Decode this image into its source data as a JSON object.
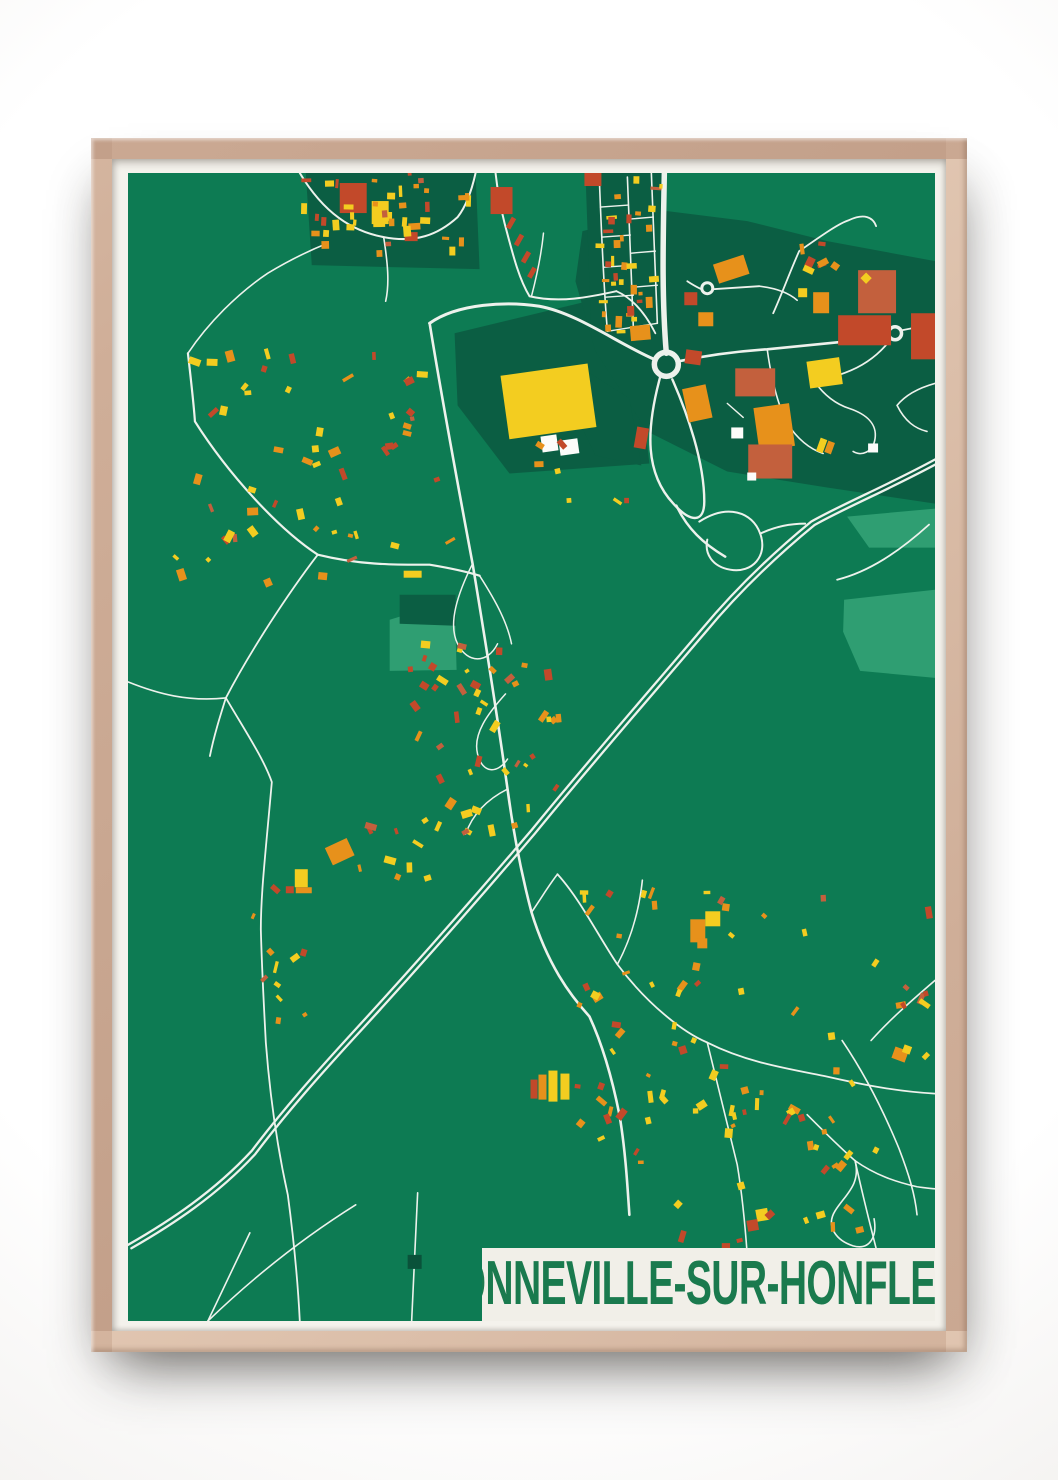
{
  "poster": {
    "title": "GONNEVILLE-SUR-HONFLEUR"
  },
  "band": {
    "x": 354,
    "y": 1073,
    "w": 454,
    "h": 73,
    "bg": "#f1efe8",
    "text_color": "#1a7a4e",
    "font_size": 62
  },
  "palette": {
    "base": "#0d7b53",
    "dark": "#0b5e43",
    "darker": "#0a523a",
    "light": "#2f9e72",
    "road": "#edf2ec",
    "y": "#f3cd20",
    "o": "#e7911b",
    "r": "#c2492a",
    "t": "#c3603d",
    "w": "#fcfcfa",
    "g": "#0a523a",
    "matte": "#f4f2ec",
    "frame_wood": "#cfae98",
    "wall": "#ffffff"
  },
  "map": {
    "width": 808,
    "height": 1146,
    "patches_dark": [
      "327,160 502,118 522,290 382,300 330,232",
      "455,58 540,38 620,48 700,68 808,88 808,330 700,314 600,298 520,258 468,178 448,108",
      "455,195 502,225 514,292 468,282 446,236",
      "458,0 535,0 541,165 464,163",
      "178,0 348,0 352,96 184,92",
      "272,421 328,421 328,452 272,450"
    ],
    "patches_light": [
      "262,446 327,426 329,496 262,497",
      "717,426 808,416 808,504 733,497 716,458",
      "720,343 808,335 808,374 742,374",
      "700,1120 790,1112 800,1146 706,1146"
    ],
    "roads": [
      {
        "d": "M537,0 C536,60 534,120 539,180",
        "w": 5.5
      },
      {
        "d": "M527,186 C490,170 450,140 412,133 C380,128 330,130 302,150",
        "w": 3
      },
      {
        "d": "M302,150 C315,230 330,310 345,390 C355,450 368,530 380,615 C386,660 394,700 404,738 C420,790 442,820 462,842 C475,870 485,905 492,940 C498,975 500,1010 502,1040",
        "w": 2.6
      },
      {
        "d": "M368,0 C370,18 373,34 377,50 C385,80 391,105 402,123 C432,130 462,124 489,118",
        "w": 2
      },
      {
        "d": "M489,118 C505,125 518,140 528,160",
        "w": 1.8
      },
      {
        "d": "M60,180 C64,215 66,232 67,248 C100,300 150,355 190,381 C235,392 270,391 302,391 C320,394 336,397 352,402",
        "w": 2.2
      },
      {
        "d": "M190,381 C160,420 122,478 98,524 C92,543 86,562 82,582",
        "w": 1.8
      },
      {
        "d": "M98,524 C118,558 136,585 144,608 C138,676 133,718 133,755 C134,795 136,830 138,868 C142,920 150,975 160,1020 C166,1065 170,1105 172,1146",
        "w": 1.8
      },
      {
        "d": "M0,508 C30,520 60,528 98,524",
        "w": 1.6
      },
      {
        "d": "M172,0 C196,40 224,58 256,64 C288,70 310,62 330,44 C338,34 344,18 348,0",
        "w": 2
      },
      {
        "d": "M256,64 C260,90 262,110 258,128",
        "w": 1.6
      },
      {
        "d": "M60,180 C80,150 110,120 140,100 C160,88 180,78 200,70",
        "w": 1.6
      },
      {
        "d": "M472,8 C474,60 476,110 480,158",
        "w": 1.6
      },
      {
        "d": "M500,4 C502,55 504,105 506,155",
        "w": 1.6
      },
      {
        "d": "M524,0 C526,50 528,100 530,150",
        "w": 1.6
      },
      {
        "d": "M473,34 L501,32",
        "w": 1.4
      },
      {
        "d": "M475,64 L503,62",
        "w": 1.4
      },
      {
        "d": "M477,94 L505,92",
        "w": 1.4
      },
      {
        "d": "M478,124 L506,122",
        "w": 1.4
      },
      {
        "d": "M502,46 L526,44",
        "w": 1.4
      },
      {
        "d": "M504,80 L528,78",
        "w": 1.4
      },
      {
        "d": "M506,114 L530,112",
        "w": 1.4
      },
      {
        "d": "M480,158 L530,150",
        "w": 1.4
      },
      {
        "d": "M560,108 C566,112 570,114 574,116",
        "w": 1.8
      },
      {
        "d": "M586,116 L632,113",
        "w": 1.8
      },
      {
        "d": "M632,113 C650,115 662,120 670,127",
        "w": 1.6
      },
      {
        "d": "M646,140 C655,120 663,98 672,78 C695,62 712,50 722,47 C737,40 746,44 749,53",
        "w": 1.8
      },
      {
        "d": "M551,188 C580,182 610,178 640,176 C680,172 720,168 761,164",
        "w": 2.6
      },
      {
        "d": "M775,157 C790,154 800,152 808,151",
        "w": 1.8
      },
      {
        "d": "M763,167 C752,181 738,191 724,197 C710,203 698,206 688,209",
        "w": 1.8
      },
      {
        "d": "M688,209 C698,223 710,231 722,235 C740,241 750,251 748,265 C746,279 734,283 726,278",
        "w": 1.6
      },
      {
        "d": "M640,176 C644,205 650,230 660,250 C672,268 684,276 696,280",
        "w": 1.6
      },
      {
        "d": "M600,230 L616,244",
        "w": 1.4
      },
      {
        "d": "M660,250 C655,270 650,285 648,300",
        "w": 1.4
      },
      {
        "d": "M808,210 C790,215 778,222 770,232 C778,248 788,255 800,258",
        "w": 1.6
      },
      {
        "d": "M533,203 C518,258 518,300 546,330 C564,350 577,349 577,328 C577,288 560,240 545,206",
        "w": 2.4
      },
      {
        "d": "M549,332 C560,355 576,370 598,383",
        "w": 2.4
      },
      {
        "d": "M572,348 C600,330 625,338 633,360 C641,382 625,400 603,396 C585,393 577,380 580,366",
        "w": 2
      },
      {
        "d": "M633,360 C650,352 665,350 678,350",
        "w": 2
      },
      {
        "d": "M808,286 C760,312 716,330 684,348 C640,384 604,420 574,456 C515,525 458,590 404,656 C345,725 283,795 224,859 C190,896 155,935 124,976 C86,1017 42,1046 0,1070",
        "w": 2.3,
        "dup": [
          3.4,
          3.4
        ]
      },
      {
        "d": "M802,351 C772,378 742,398 710,406",
        "w": 1.8
      },
      {
        "d": "M404,738 C415,722 422,710 430,700",
        "w": 1.6
      },
      {
        "d": "M430,700 C452,724 470,760 490,790 C520,830 556,858 580,868 C620,888 660,894 700,902 C740,911 772,917 808,919",
        "w": 1.8
      },
      {
        "d": "M515,706 C512,734 505,762 490,790",
        "w": 1.6
      },
      {
        "d": "M580,868 C590,910 600,950 610,990 C615,1020 618,1052 620,1080",
        "w": 1.6
      },
      {
        "d": "M715,866 C738,900 758,940 772,974 C782,1000 788,1020 790,1040",
        "w": 1.6
      },
      {
        "d": "M680,940 C700,960 714,974 728,986 C748,1000 768,1007 790,1012 C798,1013 804,1014 808,1014",
        "w": 1.6
      },
      {
        "d": "M728,986 C734,1010 718,1020 708,1036 C698,1052 710,1066 726,1071 C744,1076 750,1060 747,1044",
        "w": 1.6
      },
      {
        "d": "M728,986 C738,1032 752,1086 768,1146",
        "w": 1.6
      },
      {
        "d": "M808,806 C780,830 760,848 744,866",
        "w": 1.6
      },
      {
        "d": "M122,1058 L80,1146",
        "w": 1.6
      },
      {
        "d": "M80,1146 C130,1098 180,1060 228,1030",
        "w": 1.6
      },
      {
        "d": "M290,1018 C288,1060 286,1102 284,1146",
        "w": 1.6
      },
      {
        "d": "M345,390 C330,420 320,450 330,470 C340,490 360,490 370,470",
        "w": 1.5
      },
      {
        "d": "M378,520 C360,540 345,560 350,580 C355,600 370,600 380,585",
        "w": 1.5
      },
      {
        "d": "M352,402 C370,430 380,450 384,470",
        "w": 1.5
      },
      {
        "d": "M380,615 C360,625 345,640 338,660",
        "w": 1.5
      },
      {
        "d": "M404,123 C410,100 414,80 416,60",
        "w": 1.5
      }
    ],
    "circles": [
      {
        "cx": 539,
        "cy": 191,
        "r": 12,
        "sw": 5.5
      },
      {
        "cx": 580,
        "cy": 115,
        "r": 5.5,
        "sw": 3
      },
      {
        "cx": 768,
        "cy": 160,
        "r": 6.5,
        "sw": 3.5
      }
    ],
    "buildings": [
      [
        377,
        196,
        88,
        64,
        -8,
        "y"
      ],
      [
        414,
        262,
        16,
        16,
        -8,
        "w"
      ],
      [
        432,
        266,
        19,
        15,
        -8,
        "w"
      ],
      [
        588,
        86,
        32,
        20,
        -18,
        "o"
      ],
      [
        557,
        119,
        13,
        13,
        0,
        "r"
      ],
      [
        571,
        139,
        15,
        14,
        0,
        "o"
      ],
      [
        503,
        152,
        20,
        15,
        -5,
        "o"
      ],
      [
        558,
        177,
        16,
        14,
        8,
        "r"
      ],
      [
        608,
        195,
        40,
        28,
        0,
        "t"
      ],
      [
        629,
        232,
        36,
        43,
        -8,
        "o"
      ],
      [
        621,
        271,
        44,
        34,
        0,
        "t"
      ],
      [
        604,
        254,
        12,
        11,
        0,
        "w"
      ],
      [
        620,
        299,
        9,
        8,
        0,
        "w"
      ],
      [
        731,
        97,
        38,
        43,
        0,
        "t"
      ],
      [
        735,
        101,
        8,
        8,
        45,
        "y"
      ],
      [
        686,
        119,
        16,
        21,
        0,
        "o"
      ],
      [
        671,
        115,
        9,
        9,
        0,
        "y"
      ],
      [
        711,
        142,
        53,
        30,
        0,
        "r"
      ],
      [
        784,
        140,
        24,
        46,
        0,
        "r"
      ],
      [
        681,
        186,
        33,
        27,
        -8,
        "y"
      ],
      [
        691,
        265,
        7,
        14,
        20,
        "y"
      ],
      [
        699,
        268,
        7,
        12,
        20,
        "o"
      ],
      [
        741,
        270,
        10,
        9,
        0,
        "w"
      ],
      [
        508,
        254,
        12,
        21,
        10,
        "r"
      ],
      [
        558,
        213,
        24,
        34,
        -12,
        "o"
      ],
      [
        212,
        10,
        27,
        30,
        0,
        "r"
      ],
      [
        244,
        28,
        17,
        23,
        0,
        "y"
      ],
      [
        277,
        59,
        13,
        9,
        0,
        "r"
      ],
      [
        363,
        14,
        22,
        27,
        0,
        "r"
      ],
      [
        381,
        44,
        5,
        12,
        30,
        "r"
      ],
      [
        389,
        61,
        5,
        12,
        30,
        "r"
      ],
      [
        396,
        78,
        5,
        12,
        30,
        "r"
      ],
      [
        402,
        94,
        5,
        11,
        30,
        "r"
      ],
      [
        457,
        0,
        17,
        13,
        0,
        "r"
      ],
      [
        200,
        668,
        24,
        19,
        -25,
        "o"
      ],
      [
        167,
        695,
        13,
        18,
        0,
        "y"
      ],
      [
        168,
        713,
        16,
        6,
        0,
        "o"
      ],
      [
        158,
        712,
        8,
        7,
        0,
        "r"
      ],
      [
        276,
        397,
        18,
        7,
        0,
        "y"
      ],
      [
        563,
        745,
        15,
        23,
        0,
        "o"
      ],
      [
        578,
        737,
        15,
        15,
        0,
        "y"
      ],
      [
        570,
        764,
        10,
        10,
        0,
        "o"
      ],
      [
        421,
        896,
        9,
        31,
        0,
        "y"
      ],
      [
        433,
        899,
        9,
        26,
        0,
        "y"
      ],
      [
        411,
        900,
        8,
        25,
        0,
        "o"
      ],
      [
        403,
        905,
        7,
        19,
        0,
        "r"
      ],
      [
        629,
        1034,
        12,
        12,
        -10,
        "y"
      ],
      [
        620,
        1045,
        11,
        11,
        -10,
        "r"
      ],
      [
        766,
        874,
        14,
        12,
        20,
        "o"
      ],
      [
        776,
        871,
        8,
        8,
        20,
        "y"
      ],
      [
        280,
        1080,
        14,
        14,
        0,
        "g"
      ]
    ],
    "clusters": [
      {
        "seed": 11,
        "cx": 255,
        "cy": 38,
        "w": 170,
        "h": 80,
        "n": 40,
        "axis": true
      },
      {
        "seed": 22,
        "cx": 500,
        "cy": 80,
        "w": 64,
        "h": 158,
        "n": 36,
        "axis": true
      },
      {
        "seed": 33,
        "cx": 688,
        "cy": 82,
        "w": 44,
        "h": 36,
        "n": 7,
        "axis": false
      },
      {
        "seed": 44,
        "cx": 180,
        "cy": 285,
        "w": 290,
        "h": 240,
        "n": 55,
        "axis": false
      },
      {
        "seed": 55,
        "cx": 352,
        "cy": 560,
        "w": 150,
        "h": 195,
        "n": 48,
        "axis": false
      },
      {
        "seed": 66,
        "cx": 575,
        "cy": 835,
        "w": 270,
        "h": 240,
        "n": 52,
        "axis": false
      },
      {
        "seed": 77,
        "cx": 148,
        "cy": 790,
        "w": 70,
        "h": 170,
        "n": 11,
        "axis": false
      },
      {
        "seed": 88,
        "cx": 775,
        "cy": 840,
        "w": 60,
        "h": 210,
        "n": 9,
        "axis": false
      },
      {
        "seed": 99,
        "cx": 640,
        "cy": 1050,
        "w": 190,
        "h": 60,
        "n": 10,
        "axis": false
      },
      {
        "seed": 111,
        "cx": 438,
        "cy": 300,
        "w": 120,
        "h": 80,
        "n": 7,
        "axis": false
      },
      {
        "seed": 122,
        "cx": 262,
        "cy": 700,
        "w": 70,
        "h": 110,
        "n": 9,
        "axis": false
      },
      {
        "seed": 133,
        "cx": 700,
        "cy": 950,
        "w": 120,
        "h": 90,
        "n": 12,
        "axis": false
      },
      {
        "seed": 144,
        "cx": 540,
        "cy": 960,
        "w": 160,
        "h": 110,
        "n": 14,
        "axis": false
      }
    ]
  }
}
